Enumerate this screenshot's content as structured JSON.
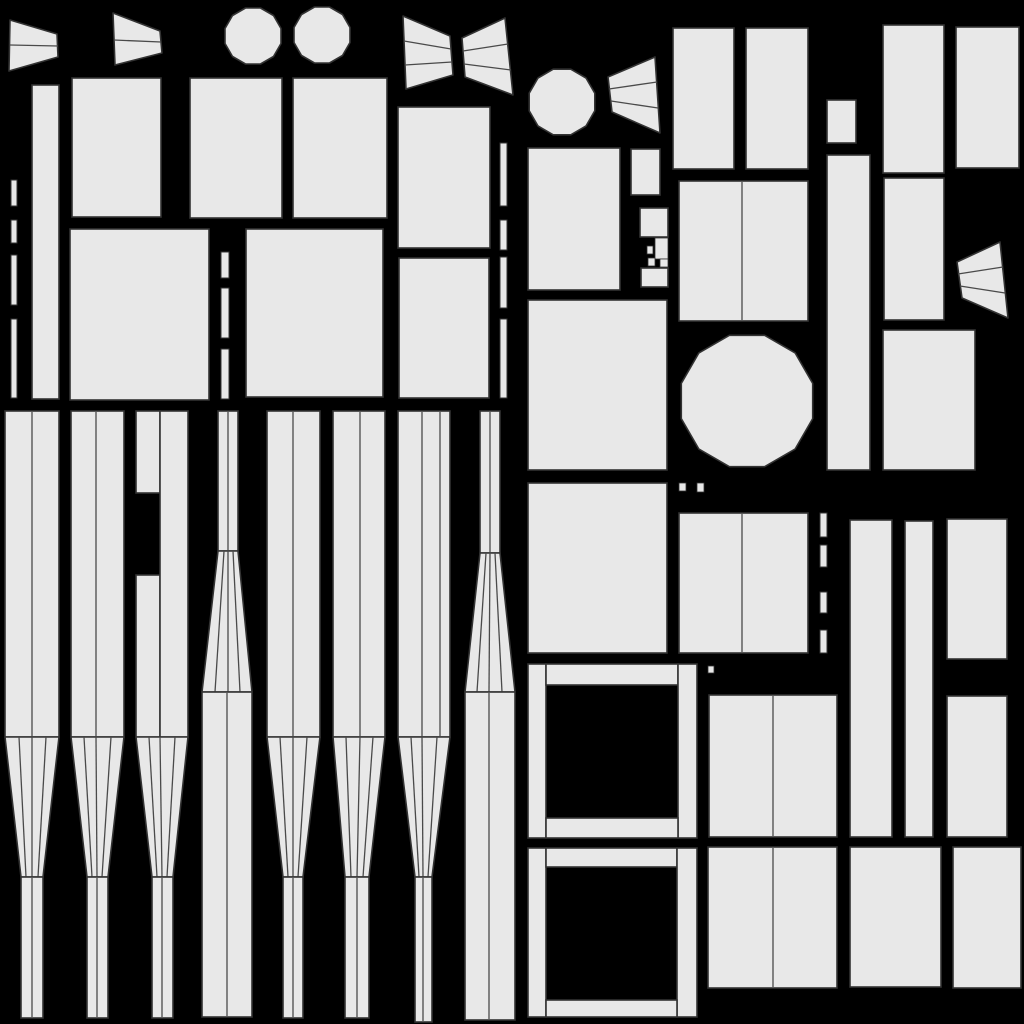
{
  "canvas": {
    "width": 1024,
    "height": 1024,
    "background": "#000000",
    "shape_fill": "#e8e8e8",
    "outline_color": "#333333",
    "line_color": "#4a4a4a"
  },
  "shapes": [
    {
      "name": "fan-wedge-top-left-1",
      "type": "poly",
      "pts": [
        [
          10,
          20
        ],
        [
          57,
          34
        ],
        [
          58,
          57
        ],
        [
          9,
          71
        ]
      ],
      "lines": [
        [
          [
            10,
            45
          ],
          [
            58,
            46
          ]
        ]
      ]
    },
    {
      "name": "fan-wedge-top-left-2",
      "type": "poly",
      "pts": [
        [
          113,
          13
        ],
        [
          160,
          31
        ],
        [
          162,
          53
        ],
        [
          115,
          65
        ]
      ],
      "lines": [
        [
          [
            114,
            40
          ],
          [
            161,
            42
          ]
        ]
      ]
    },
    {
      "name": "bowtie-fan-left",
      "type": "poly",
      "pts": [
        [
          403,
          16
        ],
        [
          450,
          36
        ],
        [
          453,
          75
        ],
        [
          406,
          89
        ]
      ],
      "lines": [
        [
          [
            404,
            41
          ],
          [
            451,
            49
          ]
        ],
        [
          [
            405,
            65
          ],
          [
            452,
            62
          ]
        ]
      ]
    },
    {
      "name": "bowtie-fan-right",
      "type": "poly",
      "pts": [
        [
          462,
          38
        ],
        [
          505,
          18
        ],
        [
          513,
          95
        ],
        [
          465,
          77
        ]
      ],
      "lines": [
        [
          [
            463,
            51
          ],
          [
            508,
            44
          ]
        ],
        [
          [
            464,
            64
          ],
          [
            511,
            70
          ]
        ]
      ]
    },
    {
      "name": "fan-wedge-middle",
      "type": "poly",
      "pts": [
        [
          608,
          77
        ],
        [
          655,
          57
        ],
        [
          660,
          133
        ],
        [
          612,
          112
        ]
      ],
      "lines": [
        [
          [
            609,
            89
          ],
          [
            657,
            82
          ]
        ],
        [
          [
            611,
            101
          ],
          [
            658,
            108
          ]
        ]
      ]
    },
    {
      "name": "fan-wedge-right",
      "type": "poly",
      "pts": [
        [
          957,
          262
        ],
        [
          1000,
          242
        ],
        [
          1008,
          318
        ],
        [
          962,
          298
        ]
      ],
      "lines": [
        [
          [
            958,
            274
          ],
          [
            1003,
            267
          ]
        ],
        [
          [
            960,
            286
          ],
          [
            1005,
            293
          ]
        ]
      ]
    },
    {
      "name": "disc-top-1",
      "type": "ngon",
      "cx": 253,
      "cy": 36,
      "r": 29,
      "n": 12
    },
    {
      "name": "disc-top-2",
      "type": "ngon",
      "cx": 322,
      "cy": 35,
      "r": 29,
      "n": 12
    },
    {
      "name": "disc-middle",
      "type": "ngon",
      "cx": 562,
      "cy": 102,
      "r": 34,
      "n": 12
    },
    {
      "name": "disc-large",
      "type": "ngon",
      "cx": 747,
      "cy": 401,
      "r": 68,
      "n": 12
    },
    {
      "name": "panel-tall-narrow",
      "type": "rect",
      "x": 32,
      "y": 85,
      "w": 27,
      "h": 314
    },
    {
      "name": "panel",
      "type": "rect",
      "x": 72,
      "y": 78,
      "w": 89,
      "h": 139
    },
    {
      "name": "panel",
      "type": "rect",
      "x": 190,
      "y": 78,
      "w": 92,
      "h": 140
    },
    {
      "name": "panel",
      "type": "rect",
      "x": 293,
      "y": 78,
      "w": 94,
      "h": 140
    },
    {
      "name": "panel",
      "type": "rect",
      "x": 398,
      "y": 107,
      "w": 92,
      "h": 141
    },
    {
      "name": "panel",
      "type": "rect",
      "x": 70,
      "y": 229,
      "w": 139,
      "h": 171
    },
    {
      "name": "panel",
      "type": "rect",
      "x": 246,
      "y": 229,
      "w": 137,
      "h": 168
    },
    {
      "name": "panel",
      "type": "rect",
      "x": 399,
      "y": 258,
      "w": 90,
      "h": 140
    },
    {
      "name": "panel",
      "type": "rect",
      "x": 528,
      "y": 148,
      "w": 92,
      "h": 142
    },
    {
      "name": "panel-small",
      "type": "rect",
      "x": 631,
      "y": 149,
      "w": 29,
      "h": 46
    },
    {
      "name": "cluster-top",
      "type": "rect",
      "x": 640,
      "y": 208,
      "w": 28,
      "h": 29
    },
    {
      "name": "cluster-bits",
      "type": "dots",
      "rects": [
        [
          647,
          246,
          6,
          8
        ],
        [
          655,
          238,
          13,
          21
        ],
        [
          648,
          258,
          7,
          8
        ],
        [
          660,
          259,
          8,
          8
        ]
      ]
    },
    {
      "name": "cluster-bottom",
      "type": "rect",
      "x": 641,
      "y": 268,
      "w": 27,
      "h": 19
    },
    {
      "name": "panel",
      "type": "rect",
      "x": 528,
      "y": 300,
      "w": 139,
      "h": 170
    },
    {
      "name": "panel",
      "type": "rect",
      "x": 528,
      "y": 483,
      "w": 139,
      "h": 170
    },
    {
      "name": "panel",
      "type": "rect",
      "x": 673,
      "y": 28,
      "w": 61,
      "h": 141
    },
    {
      "name": "panel",
      "type": "rect",
      "x": 746,
      "y": 28,
      "w": 62,
      "h": 141
    },
    {
      "name": "panel-small",
      "type": "rect",
      "x": 827,
      "y": 100,
      "w": 29,
      "h": 43
    },
    {
      "name": "panel-tall",
      "type": "rect",
      "x": 827,
      "y": 155,
      "w": 43,
      "h": 315
    },
    {
      "name": "panel",
      "type": "rect",
      "x": 883,
      "y": 25,
      "w": 61,
      "h": 148
    },
    {
      "name": "panel",
      "type": "rect",
      "x": 956,
      "y": 27,
      "w": 63,
      "h": 141
    },
    {
      "name": "panel-pair",
      "type": "rect",
      "x": 679,
      "y": 181,
      "w": 129,
      "h": 140,
      "vlines": [
        742
      ]
    },
    {
      "name": "panel",
      "type": "rect",
      "x": 884,
      "y": 178,
      "w": 60,
      "h": 142
    },
    {
      "name": "panel",
      "type": "rect",
      "x": 883,
      "y": 330,
      "w": 92,
      "h": 140
    },
    {
      "name": "panel-pair",
      "type": "rect",
      "x": 679,
      "y": 513,
      "w": 129,
      "h": 140,
      "vlines": [
        742
      ]
    },
    {
      "name": "panel-tall",
      "type": "rect",
      "x": 850,
      "y": 520,
      "w": 42,
      "h": 317
    },
    {
      "name": "panel-tall",
      "type": "rect",
      "x": 905,
      "y": 521,
      "w": 28,
      "h": 316
    },
    {
      "name": "panel",
      "type": "rect",
      "x": 947,
      "y": 519,
      "w": 60,
      "h": 140
    },
    {
      "name": "panel",
      "type": "rect",
      "x": 947,
      "y": 696,
      "w": 60,
      "h": 141
    },
    {
      "name": "panel-pair",
      "type": "rect",
      "x": 709,
      "y": 695,
      "w": 128,
      "h": 142,
      "vlines": [
        773
      ]
    },
    {
      "name": "panel-pair",
      "type": "rect",
      "x": 708,
      "y": 847,
      "w": 129,
      "h": 141,
      "vlines": [
        773
      ]
    },
    {
      "name": "panel",
      "type": "rect",
      "x": 850,
      "y": 847,
      "w": 91,
      "h": 140
    },
    {
      "name": "panel",
      "type": "rect",
      "x": 953,
      "y": 847,
      "w": 68,
      "h": 141
    },
    {
      "name": "frame-bar-left",
      "type": "rect",
      "x": 528,
      "y": 664,
      "w": 18,
      "h": 174
    },
    {
      "name": "frame-bar-top",
      "type": "rect",
      "x": 546,
      "y": 664,
      "w": 132,
      "h": 21
    },
    {
      "name": "frame-bar-right",
      "type": "rect",
      "x": 678,
      "y": 664,
      "w": 19,
      "h": 174
    },
    {
      "name": "frame-bar-bottom",
      "type": "rect",
      "x": 546,
      "y": 818,
      "w": 132,
      "h": 20
    },
    {
      "name": "frame-bar-left",
      "type": "rect",
      "x": 528,
      "y": 848,
      "w": 18,
      "h": 169
    },
    {
      "name": "frame-bar-top",
      "type": "rect",
      "x": 546,
      "y": 848,
      "w": 131,
      "h": 19
    },
    {
      "name": "frame-bar-right",
      "type": "rect",
      "x": 677,
      "y": 848,
      "w": 20,
      "h": 169
    },
    {
      "name": "frame-bar-bottom",
      "type": "rect",
      "x": 546,
      "y": 1000,
      "w": 131,
      "h": 17
    },
    {
      "name": "seam-dashes",
      "type": "vdash",
      "x": 11,
      "w": 6,
      "segs": [
        [
          180,
          206
        ],
        [
          220,
          243
        ],
        [
          255,
          305
        ],
        [
          319,
          398
        ]
      ]
    },
    {
      "name": "seam-dashes",
      "type": "vdash",
      "x": 221,
      "w": 8,
      "segs": [
        [
          252,
          278
        ],
        [
          288,
          338
        ],
        [
          349,
          399
        ]
      ]
    },
    {
      "name": "seam-dashes",
      "type": "vdash",
      "x": 500,
      "w": 7,
      "segs": [
        [
          143,
          206
        ],
        [
          220,
          250
        ],
        [
          257,
          308
        ],
        [
          319,
          398
        ]
      ]
    },
    {
      "name": "seam-dashes",
      "type": "vdash",
      "x": 820,
      "w": 7,
      "segs": [
        [
          513,
          537
        ],
        [
          545,
          567
        ],
        [
          592,
          613
        ],
        [
          630,
          653
        ]
      ]
    },
    {
      "name": "seam-dots",
      "type": "dots",
      "rects": [
        [
          679,
          483,
          7,
          8
        ],
        [
          697,
          483,
          7,
          9
        ],
        [
          708,
          666,
          6,
          7
        ]
      ]
    },
    {
      "name": "tower-strip",
      "type": "rect",
      "x": 5,
      "y": 411,
      "w": 54,
      "h": 326,
      "vlines": [
        32
      ]
    },
    {
      "name": "tower-taper",
      "type": "poly",
      "pts": [
        [
          5,
          737
        ],
        [
          59,
          737
        ],
        [
          43,
          877
        ],
        [
          21,
          877
        ]
      ],
      "lines": [
        [
          [
            19,
            737
          ],
          [
            26,
            877
          ]
        ],
        [
          [
            32,
            737
          ],
          [
            32,
            877
          ]
        ],
        [
          [
            46,
            737
          ],
          [
            38,
            877
          ]
        ]
      ]
    },
    {
      "name": "tower-column",
      "type": "rect",
      "x": 21,
      "y": 877,
      "w": 22,
      "h": 141,
      "vlines": [
        32
      ]
    },
    {
      "name": "tower-strip",
      "type": "rect",
      "x": 71,
      "y": 411,
      "w": 53,
      "h": 326,
      "vlines": [
        96
      ]
    },
    {
      "name": "tower-taper",
      "type": "poly",
      "pts": [
        [
          71,
          737
        ],
        [
          124,
          737
        ],
        [
          108,
          877
        ],
        [
          87,
          877
        ]
      ],
      "lines": [
        [
          [
            84,
            737
          ],
          [
            92,
            877
          ]
        ],
        [
          [
            96,
            737
          ],
          [
            97,
            877
          ]
        ],
        [
          [
            111,
            737
          ],
          [
            102,
            877
          ]
        ]
      ]
    },
    {
      "name": "tower-column",
      "type": "rect",
      "x": 87,
      "y": 877,
      "w": 21,
      "h": 141,
      "vlines": [
        97
      ]
    },
    {
      "name": "tower-strip-notched-upper",
      "type": "rect",
      "x": 136,
      "y": 411,
      "w": 24,
      "h": 82
    },
    {
      "name": "tower-strip-notched-lower",
      "type": "rect",
      "x": 136,
      "y": 575,
      "w": 24,
      "h": 162
    },
    {
      "name": "tower-strip",
      "type": "rect",
      "x": 160,
      "y": 411,
      "w": 28,
      "h": 326
    },
    {
      "name": "tower-taper",
      "type": "poly",
      "pts": [
        [
          136,
          737
        ],
        [
          188,
          737
        ],
        [
          173,
          877
        ],
        [
          152,
          877
        ]
      ],
      "lines": [
        [
          [
            149,
            737
          ],
          [
            157,
            877
          ]
        ],
        [
          [
            160,
            737
          ],
          [
            162,
            877
          ]
        ],
        [
          [
            175,
            737
          ],
          [
            167,
            877
          ]
        ]
      ]
    },
    {
      "name": "tower-column",
      "type": "rect",
      "x": 152,
      "y": 877,
      "w": 21,
      "h": 141,
      "vlines": [
        162
      ]
    },
    {
      "name": "spire-strip",
      "type": "rect",
      "x": 218,
      "y": 411,
      "w": 20,
      "h": 140,
      "vlines": [
        228
      ]
    },
    {
      "name": "spire-flare",
      "type": "poly",
      "pts": [
        [
          218,
          551
        ],
        [
          238,
          551
        ],
        [
          252,
          692
        ],
        [
          202,
          692
        ]
      ],
      "lines": [
        [
          [
            224,
            551
          ],
          [
            215,
            692
          ]
        ],
        [
          [
            228,
            551
          ],
          [
            228,
            692
          ]
        ],
        [
          [
            233,
            551
          ],
          [
            240,
            692
          ]
        ]
      ]
    },
    {
      "name": "spire-column",
      "type": "rect",
      "x": 202,
      "y": 692,
      "w": 50,
      "h": 325,
      "vlines": [
        227
      ]
    },
    {
      "name": "tower-strip",
      "type": "rect",
      "x": 267,
      "y": 411,
      "w": 53,
      "h": 326,
      "vlines": [
        293
      ]
    },
    {
      "name": "tower-taper",
      "type": "poly",
      "pts": [
        [
          267,
          737
        ],
        [
          320,
          737
        ],
        [
          303,
          877
        ],
        [
          283,
          877
        ]
      ],
      "lines": [
        [
          [
            280,
            737
          ],
          [
            288,
            877
          ]
        ],
        [
          [
            293,
            737
          ],
          [
            293,
            877
          ]
        ],
        [
          [
            307,
            737
          ],
          [
            298,
            877
          ]
        ]
      ]
    },
    {
      "name": "tower-column",
      "type": "rect",
      "x": 283,
      "y": 877,
      "w": 20,
      "h": 141,
      "vlines": [
        293
      ]
    },
    {
      "name": "tower-strip",
      "type": "rect",
      "x": 333,
      "y": 411,
      "w": 52,
      "h": 326,
      "vlines": [
        360
      ]
    },
    {
      "name": "tower-taper",
      "type": "poly",
      "pts": [
        [
          333,
          737
        ],
        [
          385,
          737
        ],
        [
          369,
          877
        ],
        [
          345,
          877
        ]
      ],
      "lines": [
        [
          [
            346,
            737
          ],
          [
            351,
            877
          ]
        ],
        [
          [
            360,
            737
          ],
          [
            357,
            877
          ]
        ],
        [
          [
            373,
            737
          ],
          [
            363,
            877
          ]
        ]
      ]
    },
    {
      "name": "tower-column",
      "type": "rect",
      "x": 345,
      "y": 877,
      "w": 24,
      "h": 141,
      "vlines": [
        357
      ]
    },
    {
      "name": "tower-strip",
      "type": "rect",
      "x": 398,
      "y": 411,
      "w": 52,
      "h": 326,
      "vlines": [
        422,
        440
      ]
    },
    {
      "name": "tower-taper",
      "type": "poly",
      "pts": [
        [
          398,
          737
        ],
        [
          450,
          737
        ],
        [
          432,
          877
        ],
        [
          415,
          877
        ]
      ],
      "lines": [
        [
          [
            411,
            737
          ],
          [
            419,
            877
          ]
        ],
        [
          [
            422,
            737
          ],
          [
            423,
            877
          ]
        ],
        [
          [
            437,
            737
          ],
          [
            428,
            877
          ]
        ]
      ]
    },
    {
      "name": "tower-column",
      "type": "rect",
      "x": 415,
      "y": 877,
      "w": 17,
      "h": 145,
      "vlines": [
        423
      ]
    },
    {
      "name": "spire-strip",
      "type": "rect",
      "x": 480,
      "y": 411,
      "w": 20,
      "h": 142,
      "vlines": [
        490
      ]
    },
    {
      "name": "spire-flare",
      "type": "poly",
      "pts": [
        [
          480,
          553
        ],
        [
          500,
          553
        ],
        [
          515,
          692
        ],
        [
          465,
          692
        ]
      ],
      "lines": [
        [
          [
            486,
            553
          ],
          [
            477,
            692
          ]
        ],
        [
          [
            490,
            553
          ],
          [
            489,
            692
          ]
        ],
        [
          [
            495,
            553
          ],
          [
            502,
            692
          ]
        ]
      ]
    },
    {
      "name": "spire-column",
      "type": "rect",
      "x": 465,
      "y": 692,
      "w": 50,
      "h": 328,
      "vlines": [
        489
      ]
    }
  ]
}
